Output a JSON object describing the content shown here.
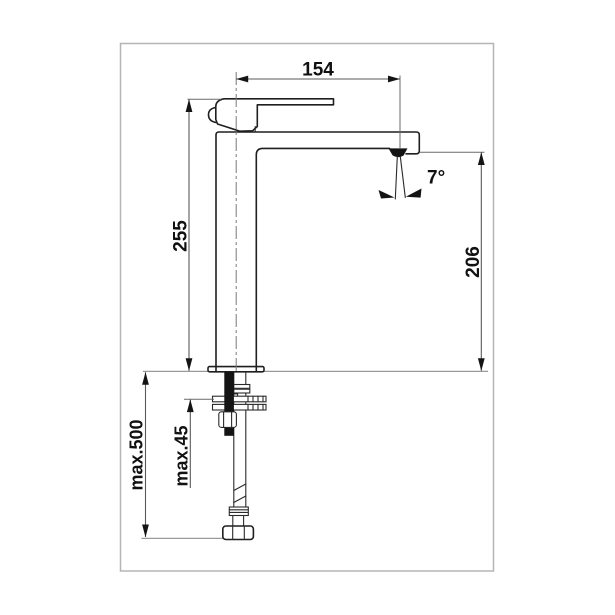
{
  "drawing": {
    "kind": "faucet-dimension-diagram",
    "dimensions": {
      "horizontal_top": "154",
      "vertical_left": "255",
      "vertical_right": "206",
      "angle": "7°",
      "vertical_far_left": "max.500",
      "vertical_mid_left": "max.45"
    },
    "colors": {
      "background": "#ffffff",
      "frame": "#b5b5b5",
      "outline": "#1f1f1f",
      "dimension_lines": "#5a5a5a",
      "solid_fill": "#141414"
    }
  }
}
